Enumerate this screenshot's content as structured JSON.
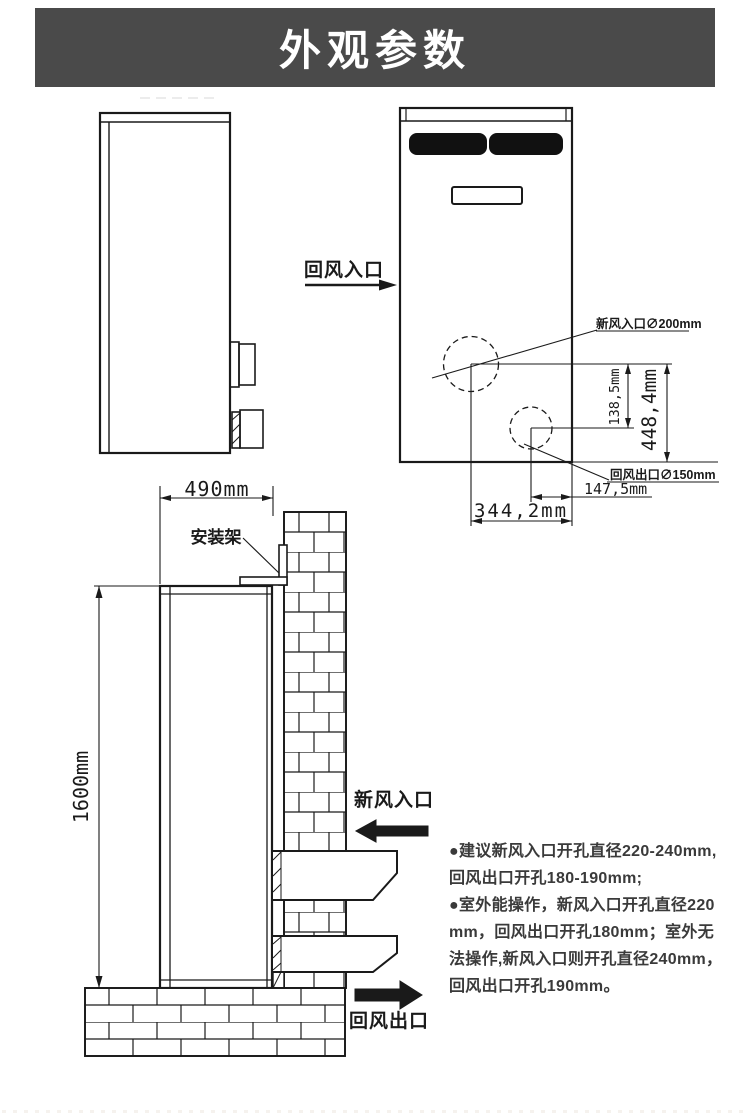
{
  "header": {
    "title": "外观参数",
    "bg_color": "#4a4a4a",
    "text_color": "#ffffff"
  },
  "front_view": {
    "return_inlet_label": "回风入口",
    "fresh_inlet_hole_label": "新风入口∅200mm",
    "return_outlet_hole_label": "回风出口∅150mm",
    "dim_circle_gap_v": "138,5mm",
    "dim_bottom_to_inlet_v": "448,4mm",
    "dim_outlet_to_edge_h": "147,5mm",
    "dim_inlet_to_edge_h": "344,2mm"
  },
  "install_view": {
    "dim_width": "490mm",
    "dim_height": "1600mm",
    "bracket_label": "安装架",
    "fresh_air_inlet_label": "新风入口",
    "return_air_outlet_label": "回风出口"
  },
  "notes": {
    "lines": [
      "●建议新风入口开孔直径220-240mm,",
      "回风出口开孔180-190mm;",
      "●室外能操作，新风入口开孔直径220",
      "mm，回风出口开孔180mm；室外无",
      "法操作,新风入口则开孔直径240mm，",
      "回风出口开孔190mm。"
    ]
  },
  "colors": {
    "line": "#1a1a1a",
    "note_text": "#3a3a3a",
    "grille": "#111111"
  }
}
